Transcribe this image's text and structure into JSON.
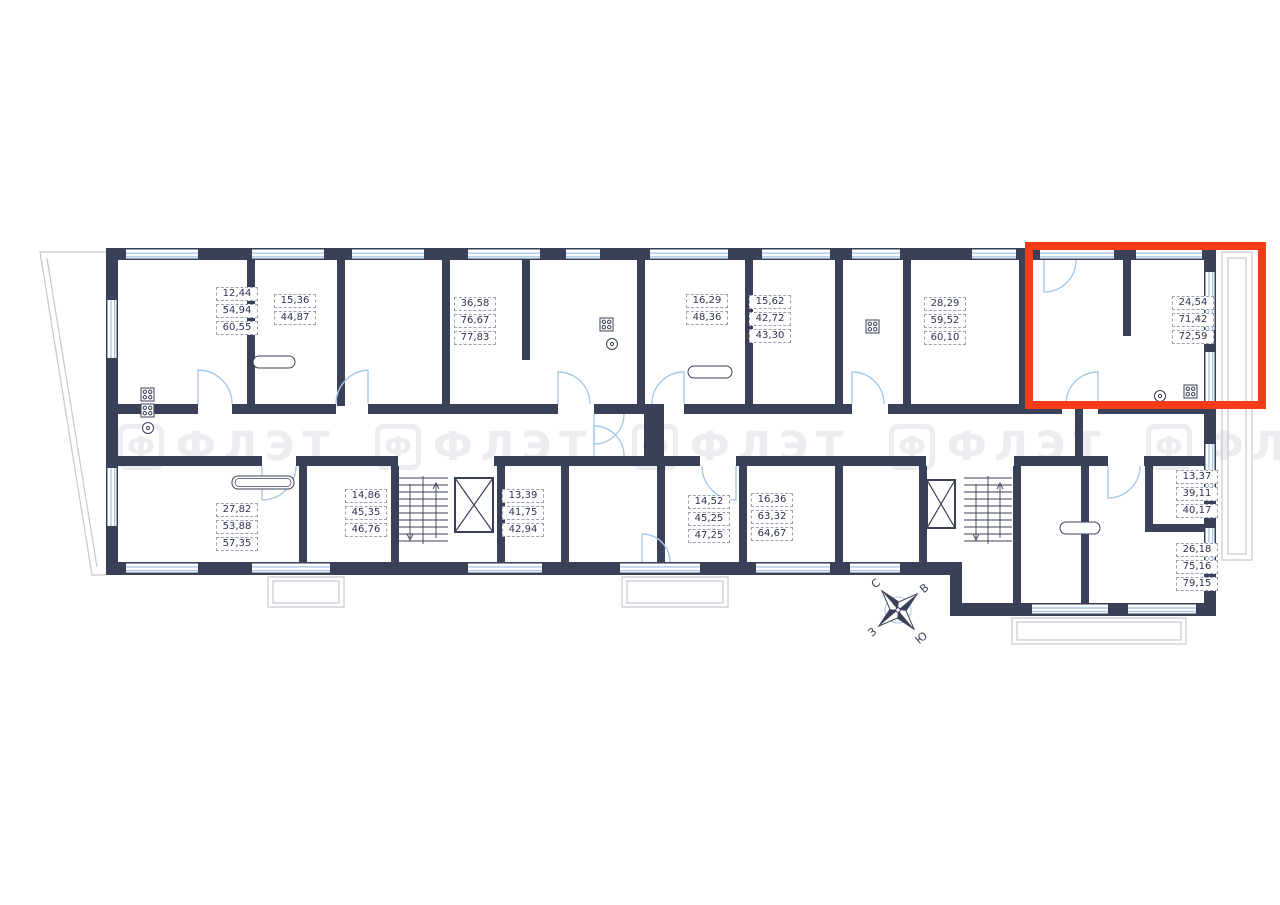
{
  "plan": {
    "apartments": [
      {
        "values": [
          "12,44",
          "54,94",
          "60,55"
        ]
      },
      {
        "values": [
          "15,36",
          "44,87"
        ]
      },
      {
        "values": [
          "36,58",
          "76,67",
          "77,83"
        ]
      },
      {
        "values": [
          "16,29",
          "48,36"
        ]
      },
      {
        "values": [
          "15,62",
          "42,72",
          "43,30"
        ]
      },
      {
        "values": [
          "28,29",
          "59,52",
          "60,10"
        ]
      },
      {
        "values": [
          "24,54",
          "71,42",
          "72,59"
        ],
        "highlighted": true
      },
      {
        "values": [
          "27,82",
          "53,88",
          "57,35"
        ]
      },
      {
        "values": [
          "14,86",
          "45,35",
          "46,76"
        ]
      },
      {
        "values": [
          "13,39",
          "41,75",
          "42,94"
        ]
      },
      {
        "values": [
          "14,52",
          "45,25",
          "47,25"
        ]
      },
      {
        "values": [
          "16,36",
          "63,32",
          "64,67"
        ]
      },
      {
        "values": [
          "13,37",
          "39,11",
          "40,17"
        ]
      },
      {
        "values": [
          "26,18",
          "75,16",
          "79,15"
        ]
      }
    ],
    "colors": {
      "wall": "#3a4057",
      "glass": "#a9c9e9",
      "highlight": "#f53b17",
      "outline": "#c5c8d0",
      "label_text": "#2c3350"
    }
  },
  "compass": {
    "north": "С",
    "east": "В",
    "west": "З",
    "south": "Ю"
  },
  "watermark": {
    "logo_letter": "Ф",
    "text": "ФЛЭТ"
  }
}
